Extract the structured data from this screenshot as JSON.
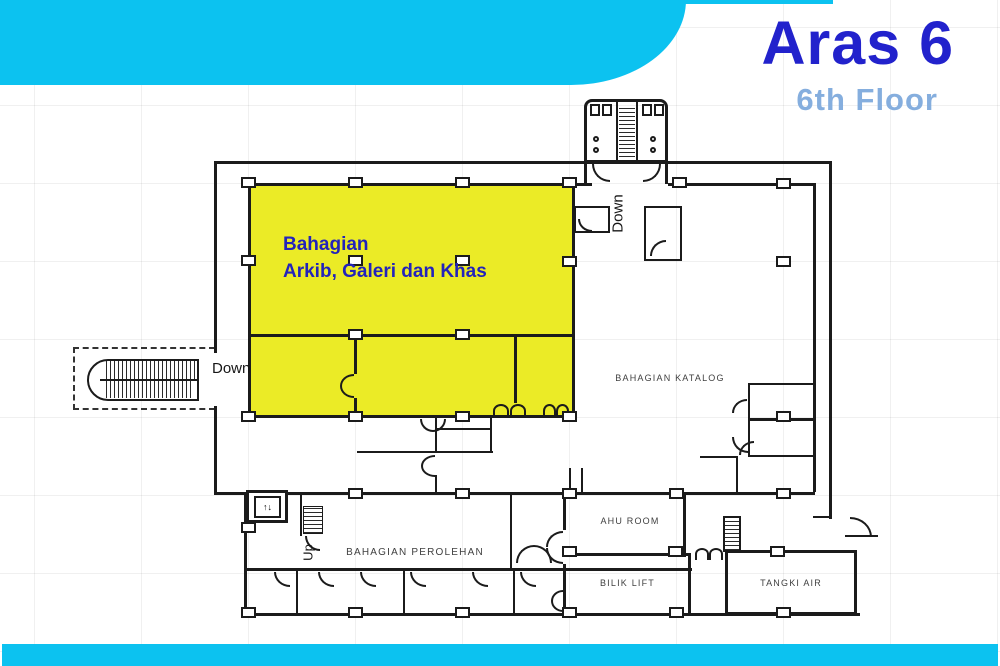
{
  "slide": {
    "title": "Aras 6",
    "subtitle": "6th Floor"
  },
  "colors": {
    "accent_cyan": "#0cc2f0",
    "title_blue": "#2222cc",
    "subtitle_blue": "#85aede",
    "highlight_yellow": "#ebeb26",
    "highlight_label_blue": "#2323bb",
    "plan_line": "#1b1b1b"
  },
  "floor_plan": {
    "highlight_area": {
      "label_line1": "Bahagian",
      "label_line2": "Arkib, Galeri dan Khas"
    },
    "rooms": {
      "katalog": "BAHAGIAN KATALOG",
      "ahu": "AHU ROOM",
      "lift": "BILIK LIFT",
      "tangki": "TANGKI AIR",
      "perolehan": "BAHAGIAN PEROLEHAN"
    },
    "annotations": {
      "down_left": "Down",
      "down_top": "Down",
      "up_center": "Up"
    },
    "icons": {
      "elevator_glyph": "↑↓"
    }
  }
}
